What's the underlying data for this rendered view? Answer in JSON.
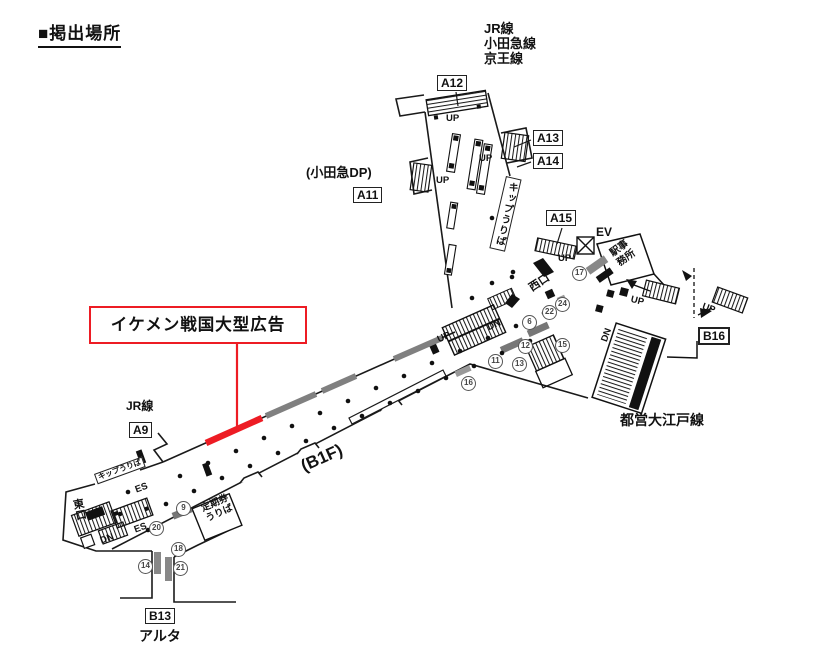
{
  "title": "■掲出場所",
  "callout": {
    "label": "イケメン戦国大型広告",
    "color": "#ed1c24"
  },
  "top_lines": [
    "JR線",
    "小田急線",
    "京王線"
  ],
  "boxes": {
    "a9": "A9",
    "a11": "A11",
    "a12": "A12",
    "a13": "A13",
    "a14": "A14",
    "a15": "A15",
    "b13": "B13",
    "b16": "B16"
  },
  "labels": {
    "odakyu_dp": "(小田急DP)",
    "jr_line": "JR線",
    "alta": "アルタ",
    "oedo_line": "都営大江戸線",
    "west_exit": "西口",
    "east_exit": "東口",
    "b1f": "(B1F)",
    "kippu_top": "キップうりば",
    "kippu_sw": "キップうりば",
    "office": [
      "駅事",
      "務所"
    ],
    "teiki": [
      "定期券",
      "うりば"
    ]
  },
  "glyphs": {
    "up": "UP",
    "dn": "DN",
    "es": "ES",
    "ev": "EV"
  },
  "markers": [
    {
      "label": "17"
    },
    {
      "label": "24"
    },
    {
      "label": "22"
    },
    {
      "label": "6"
    },
    {
      "label": "12"
    },
    {
      "label": "15"
    },
    {
      "label": "11"
    },
    {
      "label": "13"
    },
    {
      "label": "16"
    },
    {
      "label": "9"
    },
    {
      "label": "20"
    },
    {
      "label": "18"
    },
    {
      "label": "14"
    },
    {
      "label": "21"
    }
  ]
}
